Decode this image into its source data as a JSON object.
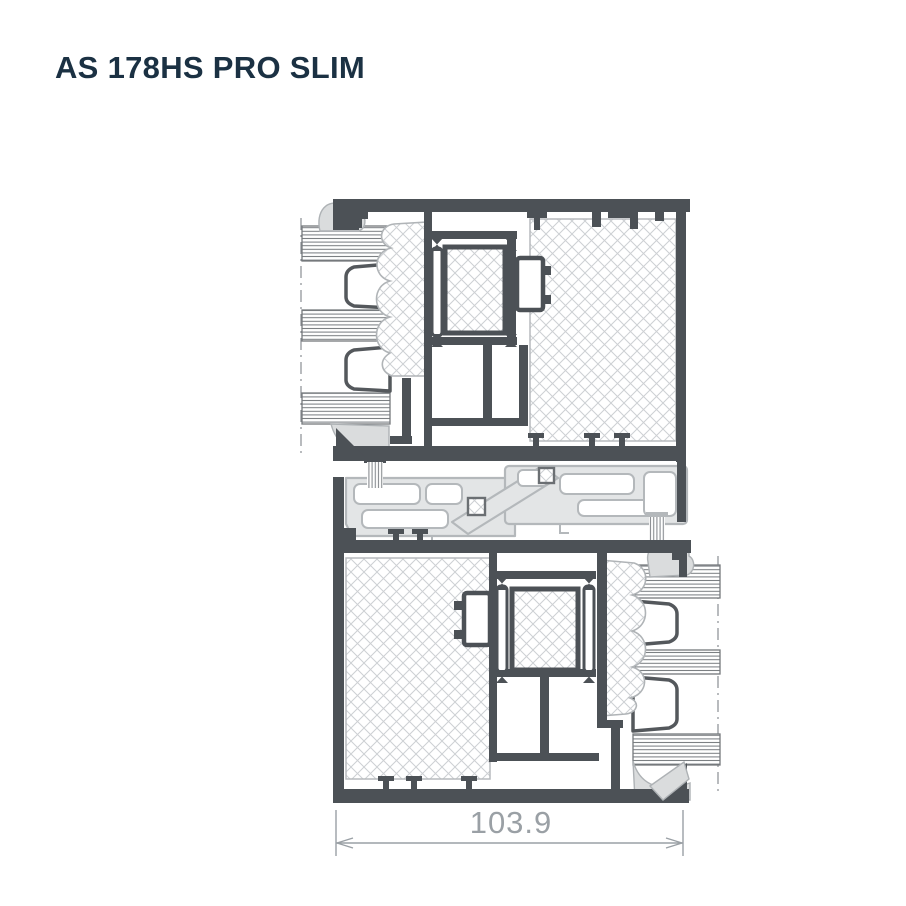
{
  "header": {
    "title": "AS 178HS PRO SLIM",
    "title_color": "#1b3143"
  },
  "drawing": {
    "dimension_label": "103.9",
    "colors": {
      "background": "#ffffff",
      "profile_dark": "#4c5156",
      "profile_light_fill": "#e3e5e6",
      "profile_light_stroke": "#b4b8bb",
      "hatch_line": "#cdd0d3",
      "glass_line": "#75797d",
      "gasket_fill": "#dadcdd",
      "dimension": "#9aa0a5"
    }
  }
}
